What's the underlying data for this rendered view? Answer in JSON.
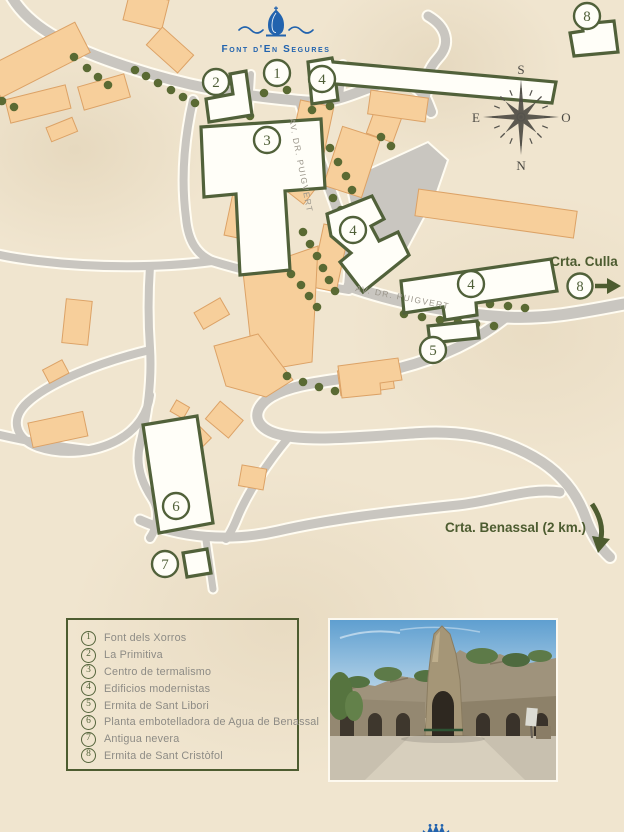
{
  "logo": {
    "title": "Font d'En Segures"
  },
  "compass": {
    "top": "S",
    "right": "O",
    "bottom": "N",
    "left": "E"
  },
  "streets": {
    "label_a": "AV. DR. PUIGVERT",
    "label_b": "AV. DR. PUIGVERT"
  },
  "routes": {
    "culla": {
      "label": "Crta. Culla",
      "marker": "8"
    },
    "benassal": {
      "label": "Crta. Benassal (2 km.)"
    }
  },
  "markers": {
    "m1": "1",
    "m2": "2",
    "m3": "3",
    "m4a": "4",
    "m4b": "4",
    "m4c": "4",
    "m5": "5",
    "m6": "6",
    "m7": "7",
    "m8_map": "8"
  },
  "legend": {
    "items": [
      {
        "number": "1",
        "label": "Font dels Xorros"
      },
      {
        "number": "2",
        "label": "La Primitiva"
      },
      {
        "number": "3",
        "label": "Centro de termalismo"
      },
      {
        "number": "4",
        "label": "Edificios modernistas"
      },
      {
        "number": "5",
        "label": "Ermita de Sant Libori"
      },
      {
        "number": "6",
        "label": "Planta embotelladora de Agua de Benassal"
      },
      {
        "number": "7",
        "label": "Antigua nevera"
      },
      {
        "number": "8",
        "label": "Ermita de Sant Cristòfol"
      }
    ]
  },
  "colors": {
    "accent_olive": "#4d5c30",
    "road_gray": "#c9c6c0",
    "building_tan": "#f7cf9b",
    "brand_blue": "#2263ae",
    "text_gray": "#8d8b85"
  }
}
